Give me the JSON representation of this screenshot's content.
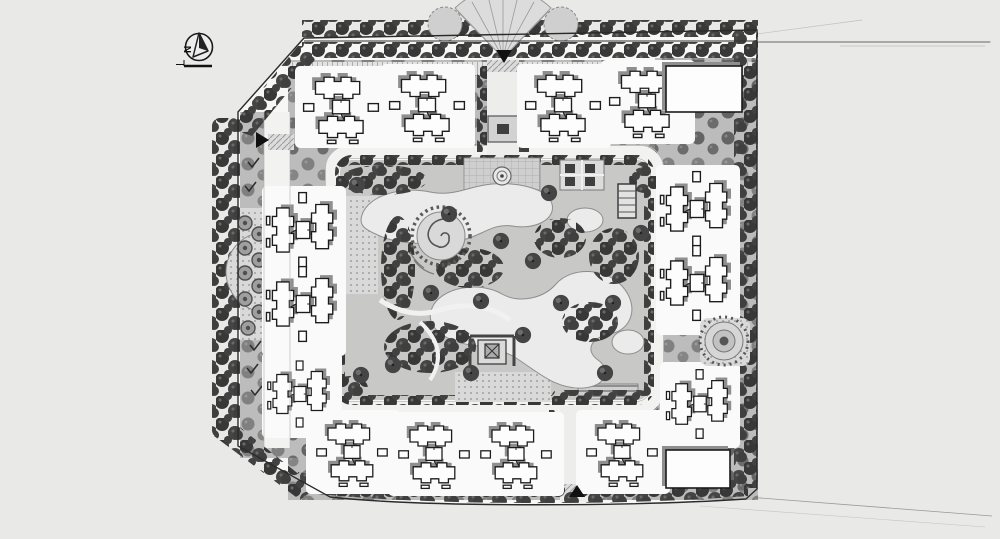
{
  "plan": {
    "north_arrow_label": "N"
  },
  "palette": {
    "page_background": "#e9e9e8",
    "paper": "#f7f7f6",
    "ink": "#222222",
    "tree_canopy_dark": "#3d3d3d",
    "tree_canopy_mid": "#545454",
    "greenery_base": "#bcbcbc",
    "park_base": "#c8c8c7",
    "road": "#f2f2f1",
    "water": "#ebebeb",
    "building_fill": "#fdfdfd",
    "building_outline": "#1c1c1c",
    "shadow": "#8f8f8f",
    "boundary_line": "#2b2b2b"
  },
  "icons": {
    "compass": "north-arrow in circle with scale bar",
    "entrance_marker_north": "filled triangle pointing down",
    "entrance_marker_west": "filled triangle pointing right",
    "entrance_marker_south": "filled triangle pointing up"
  }
}
